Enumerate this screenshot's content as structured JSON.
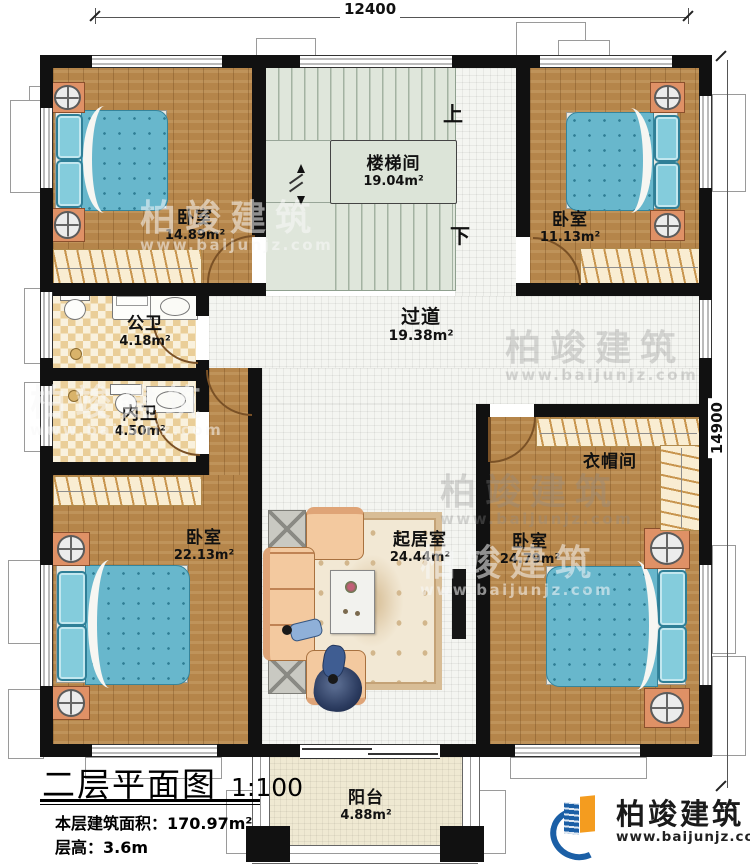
{
  "dimensions": {
    "top": "12400",
    "right": "14900"
  },
  "stairs": {
    "name": "楼梯间",
    "area": "19.04m²",
    "up": "上",
    "down": "下"
  },
  "rooms": {
    "bedroom_tl": {
      "name": "卧室",
      "area": "14.89m²"
    },
    "bedroom_tr": {
      "name": "卧室",
      "area": "11.13m²"
    },
    "public_bath": {
      "name": "公卫",
      "area": "4.18m²"
    },
    "ensuite_bath": {
      "name": "内卫",
      "area": "4.50m²"
    },
    "corridor": {
      "name": "过道",
      "area": "19.38m²"
    },
    "living": {
      "name": "起居室",
      "area": "24.44m²"
    },
    "cloakroom": {
      "name": "衣帽间"
    },
    "bedroom_bl": {
      "name": "卧室",
      "area": "22.13m²"
    },
    "bedroom_br": {
      "name": "卧室",
      "area": "24.79m²"
    },
    "balcony": {
      "name": "阳台",
      "area": "4.88m²"
    }
  },
  "title_block": {
    "title": "二层平面图",
    "scale": "1:100",
    "floor_area_label": "本层建筑面积：",
    "floor_area_value": "170.97m²",
    "floor_height_label": "层高：",
    "floor_height_value": "3.6m"
  },
  "brand": {
    "name": "柏竣建筑",
    "url": "www.baijunjz.com"
  },
  "watermark": {
    "name": "柏竣建筑",
    "url": "www.baijunjz.com"
  },
  "colors": {
    "wall": "#111111",
    "wood": "#b5854a",
    "tile": "#f4f5f1",
    "checker": "#eace98",
    "stair": "#dfe6db",
    "balcony": "#efe9d2",
    "bed_blue": "#68b7cc",
    "nightstand_orange": "#df9166",
    "brand_blue": "#1b5fa6",
    "brand_orange": "#f49c1f"
  }
}
